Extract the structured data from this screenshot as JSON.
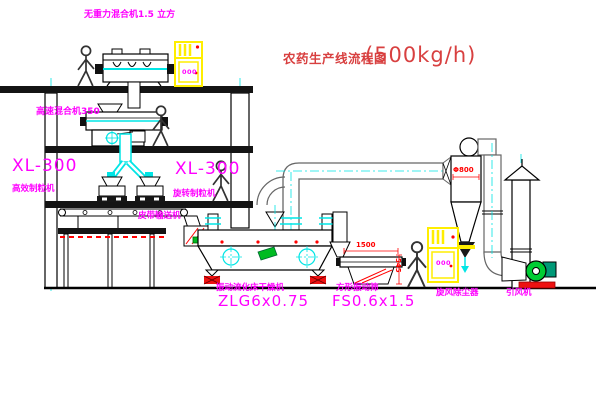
{
  "title": {
    "name": "农药生产线流程图",
    "capacity": "(500kg/h)"
  },
  "labels": {
    "zero_gravity_mixer": "无重力混合机1.5 立方",
    "high_speed_mixer": "高速混合机350",
    "granulator_left": {
      "model": "XL-300",
      "name": "高效制粒机"
    },
    "granulator_right": {
      "model": "XL-300",
      "name": "旋转制粒机"
    },
    "belt_conveyor": "皮带输送机",
    "dryer": {
      "name": "振动流化床干燥机",
      "model": "ZLG6x0.75"
    },
    "sieve": {
      "name": "方形振动筛",
      "model": "FS0.6x1.5"
    },
    "cyclone": {
      "name": "旋风除尘器",
      "dimension": "Φ800"
    },
    "fan": {
      "name": "引风机"
    }
  },
  "dimensions": {
    "sieve_length": "1500",
    "sieve_height": "545"
  },
  "panel": {
    "display": "000"
  },
  "colors": {
    "label_magenta": "#ff00ff",
    "title_red": "#d84040",
    "dimension_red": "#ff0000",
    "centerline_cyan": "#00ffff",
    "cabinet_yellow": "#ffee00",
    "fan_green": "#00cc33"
  }
}
